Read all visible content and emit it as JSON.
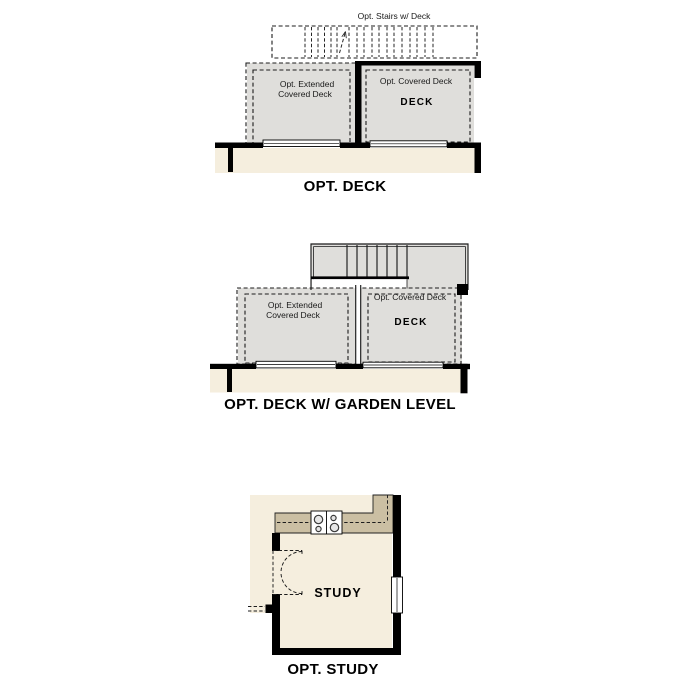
{
  "colors": {
    "deck_fill": "#dfdedb",
    "interior_fill": "#f5eede",
    "counter_fill": "#cbbfa3",
    "wall": "#000000"
  },
  "figures": {
    "opt_deck": {
      "title": "OPT. DECK",
      "stairs_label": "Opt. Stairs w/ Deck",
      "extended_deck_line1": "Opt. Extended",
      "extended_deck_line2": "Covered Deck",
      "covered_deck_label": "Opt. Covered Deck",
      "deck_label": "DECK"
    },
    "opt_deck_garden": {
      "title": "OPT. DECK W/ GARDEN LEVEL",
      "extended_deck_line1": "Opt. Extended",
      "extended_deck_line2": "Covered Deck",
      "covered_deck_label": "Opt. Covered Deck",
      "deck_label": "DECK"
    },
    "opt_study": {
      "title": "OPT. STUDY",
      "room_label": "STUDY"
    }
  }
}
